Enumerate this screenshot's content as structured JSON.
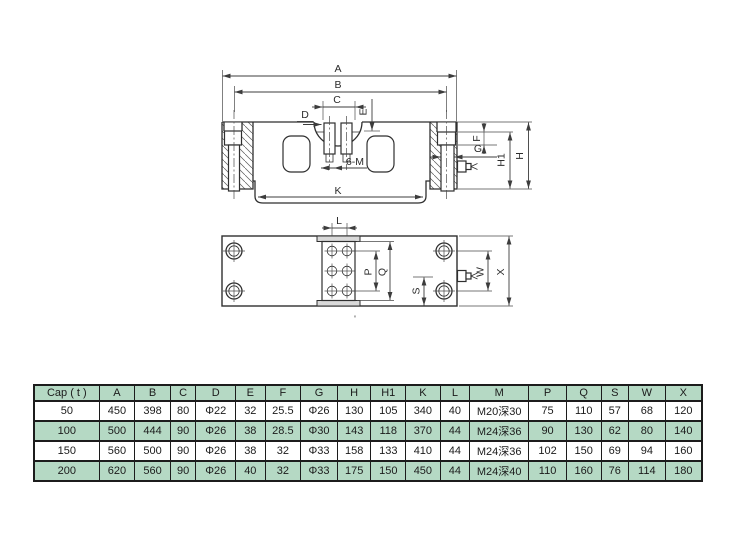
{
  "drawing": {
    "side_view": {
      "labels": {
        "A": "A",
        "B": "B",
        "C": "C",
        "D": "D",
        "E": "E",
        "F": "F",
        "G": "G",
        "H": "H",
        "H1": "H1",
        "K": "K",
        "bolt_note": "6-M"
      }
    },
    "plan_view": {
      "labels": {
        "L": "L",
        "P": "P",
        "Q": "Q",
        "S": "S",
        "W": "W",
        "X": "X"
      },
      "tick_mark": "'"
    }
  },
  "table": {
    "headers": [
      "Cap ( t )",
      "A",
      "B",
      "C",
      "D",
      "E",
      "F",
      "G",
      "H",
      "H1",
      "K",
      "L",
      "M",
      "P",
      "Q",
      "S",
      "W",
      "X"
    ],
    "rows": [
      [
        "50",
        "450",
        "398",
        "80",
        "Φ22",
        "32",
        "25.5",
        "Φ26",
        "130",
        "105",
        "340",
        "40",
        "M20深30",
        "75",
        "110",
        "57",
        "68",
        "120"
      ],
      [
        "100",
        "500",
        "444",
        "90",
        "Φ26",
        "38",
        "28.5",
        "Φ30",
        "143",
        "118",
        "370",
        "44",
        "M24深36",
        "90",
        "130",
        "62",
        "80",
        "140"
      ],
      [
        "150",
        "560",
        "500",
        "90",
        "Φ26",
        "38",
        "32",
        "Φ33",
        "158",
        "133",
        "410",
        "44",
        "M24深36",
        "102",
        "150",
        "69",
        "94",
        "160"
      ],
      [
        "200",
        "620",
        "560",
        "90",
        "Φ26",
        "40",
        "32",
        "Φ33",
        "175",
        "150",
        "450",
        "44",
        "M24深40",
        "110",
        "160",
        "76",
        "114",
        "180"
      ]
    ],
    "colors": {
      "header_bg": "#b5d9c4",
      "alt_row_bg": "#b5d9c4",
      "row_bg": "#ffffff",
      "border": "#1c1c1c"
    }
  }
}
